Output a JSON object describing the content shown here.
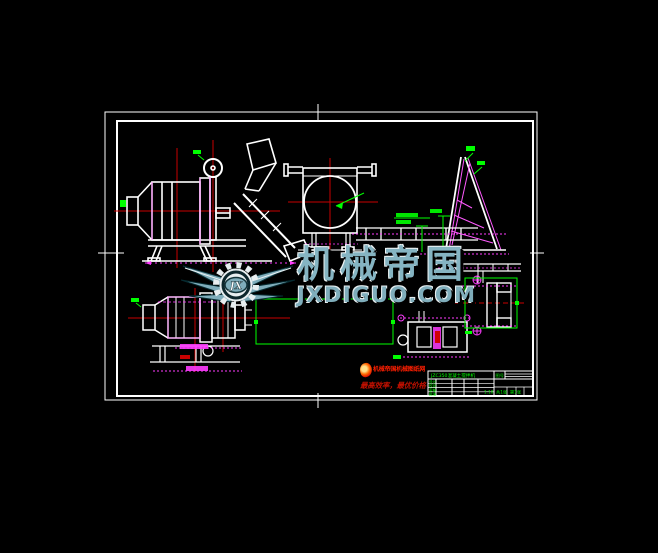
{
  "canvas": {
    "width": 658,
    "height": 553,
    "background": "#000000"
  },
  "colors": {
    "line_white": "#ffffff",
    "centerline_red": "#c80000",
    "dimension_magenta": "#ff3cff",
    "annotation_green": "#00ff00",
    "watermark_teal": "#85b4c2",
    "vendor_red": "#ff1e00"
  },
  "watermark": {
    "brand": "机械帝国",
    "domain": "JXDIGUO.COM",
    "monogram": "JX"
  },
  "vendor": {
    "company": "机械帝国机械图纸网",
    "slogan": "最高效率，最优价格"
  },
  "title_block": {
    "title": "JZC350混凝土搅拌机",
    "cell_small": "图号",
    "scale": "1:10",
    "sheet_count": "共1张",
    "sheet_no": "第1张",
    "rows": [
      "设计",
      "校对",
      "审核",
      "批准"
    ]
  }
}
